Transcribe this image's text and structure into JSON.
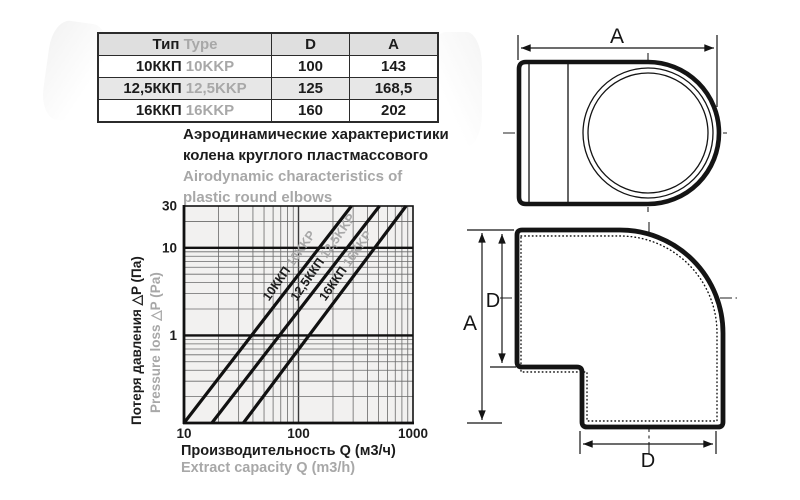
{
  "table": {
    "header": {
      "type_ru": "Тип",
      "type_en": "Type",
      "col_d": "D",
      "col_a": "A"
    },
    "rows": [
      {
        "type_ru": "10ККП",
        "type_en": "10KKP",
        "d": "100",
        "a": "143"
      },
      {
        "type_ru": "12,5ККП",
        "type_en": "12,5KKP",
        "d": "125",
        "a": "168,5"
      },
      {
        "type_ru": "16ККП",
        "type_en": "16KKP",
        "d": "160",
        "a": "202"
      }
    ]
  },
  "title": {
    "ru_line1": "Аэродинамические характеристики",
    "ru_line2": "колена круглого пластмассового",
    "en_line1": "Airodynamic characteristics of",
    "en_line2": "plastic round elbows"
  },
  "chart_data": {
    "type": "line",
    "x_scale": "log",
    "y_scale": "log",
    "xlim": [
      10,
      1000
    ],
    "ylim": [
      0.1,
      30
    ],
    "x_ticks": [
      "10",
      "100",
      "1000"
    ],
    "x_tick_values": [
      10,
      100,
      1000
    ],
    "y_ticks": [
      "30",
      "10",
      "1"
    ],
    "y_tick_values": [
      30,
      10,
      1
    ],
    "emphasized_y": [
      10,
      1
    ],
    "grid": "log minor gridlines on both axes",
    "xlabel_ru": "Производительность Q (м3/ч)",
    "xlabel_en": "Extract capacity Q (m3/h)",
    "ylabel_ru": "Потеря давления △P (Па)",
    "ylabel_en": "Pressure loss △P (Pa)",
    "series": [
      {
        "name_ru": "10ККП",
        "name_en": "10KKP",
        "points": [
          {
            "q": 10,
            "dp": 0.1
          },
          {
            "q": 290,
            "dp": 30
          }
        ]
      },
      {
        "name_ru": "12,5ККП",
        "name_en": "12,5KKP",
        "points": [
          {
            "q": 17.5,
            "dp": 0.1
          },
          {
            "q": 510,
            "dp": 30
          }
        ]
      },
      {
        "name_ru": "16ККП",
        "name_en": "16KKP",
        "points": [
          {
            "q": 33,
            "dp": 0.1
          },
          {
            "q": 870,
            "dp": 30
          }
        ]
      }
    ],
    "style": {
      "plot_bg": "#f2f1f0",
      "grid": "#6a6a6a",
      "major": "#3a3a3a",
      "emph": "#111111",
      "line": "#111111",
      "label_black": "#1c1c1c",
      "label_gray": "#a8a8a8",
      "tick_color": "#1c1c1c"
    }
  },
  "drawings": {
    "dim_a": "A",
    "dim_d": "D"
  }
}
